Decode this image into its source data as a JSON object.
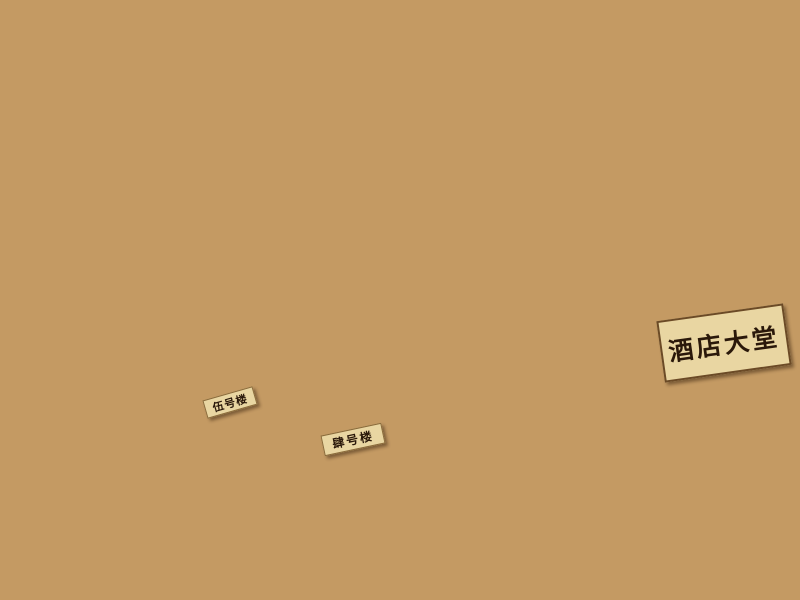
{
  "scene": {
    "type": "photograph",
    "subject": "Wooden architectural scale model of a hillside hotel resort with terraced slopes, model tree rows and labelled buildings",
    "signs": {
      "hotel_lobby": "酒店大堂",
      "building_no5": "伍号楼",
      "building_no4": "肆号楼"
    },
    "colors": {
      "background_dark": "#20140c",
      "table_wood": "#6b4326",
      "terrain_tan": "#c49a63",
      "hill_tan": "#b9905a",
      "contour_brown": "#4f3016",
      "building_light": "#ecd9ad",
      "building_red": "#9b6a48",
      "plaza_light": "#e8d7ad",
      "sign_background": "#e9d6a2",
      "sign_text": "#2a180a",
      "tree_dark": "#53391f",
      "shrub_purple": "#6b5a74"
    }
  }
}
